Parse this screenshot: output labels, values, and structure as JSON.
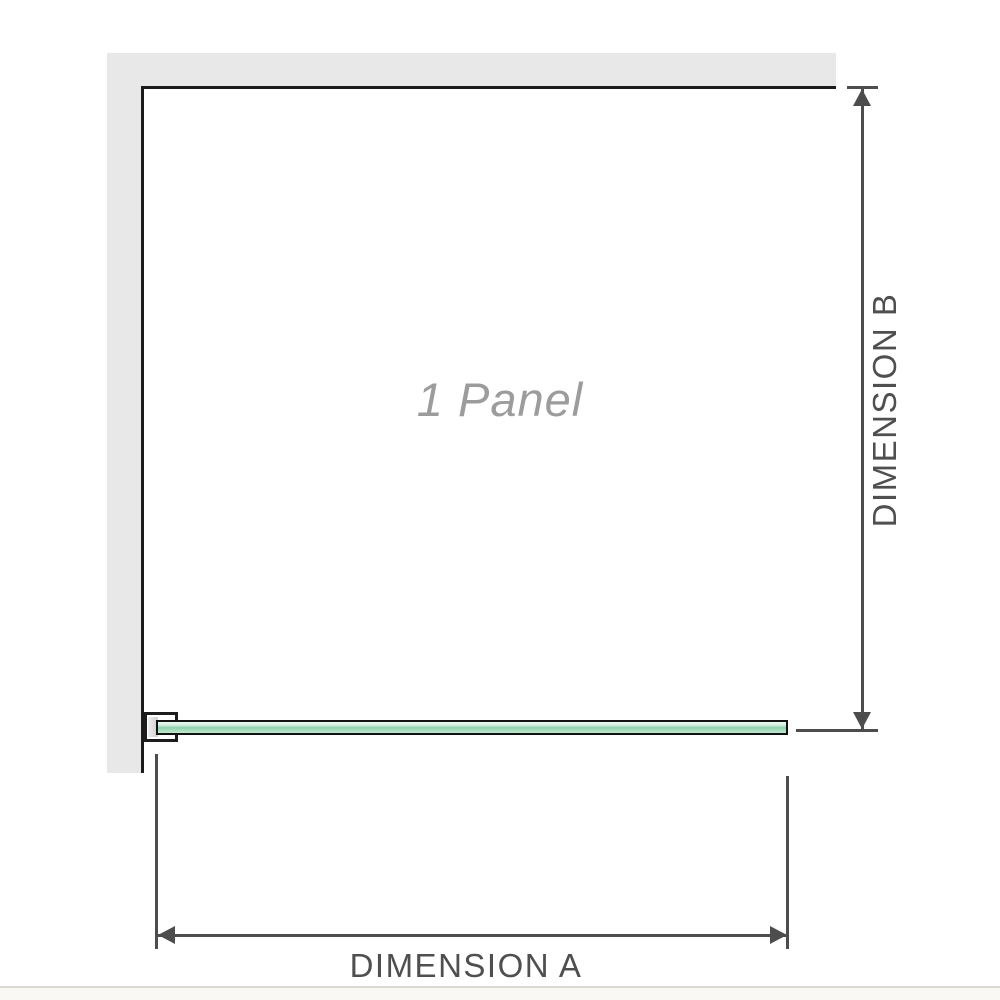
{
  "diagram": {
    "panel_label": "1 Panel",
    "dimension_a_label": "DIMENSION A",
    "dimension_b_label": "DIMENSION B",
    "icons": {
      "dimension_b_top": "arrow-up",
      "dimension_b_bottom": "arrow-down",
      "dimension_a_left": "arrow-left",
      "dimension_a_right": "arrow-right"
    }
  },
  "colors": {
    "wall": "#e8e8e8",
    "outline": "#1c1c1c",
    "dimension": "#4d4d4d",
    "label_text": "#4f4f4f",
    "panel_label_text": "#9c9c9c",
    "glass_light": "#cdeedd",
    "glass_mid": "#8ed0ab",
    "glass_dark": "#a5dcbc",
    "footer_line": "#dcd8d3",
    "footer_bg": "#f9f8f5"
  }
}
